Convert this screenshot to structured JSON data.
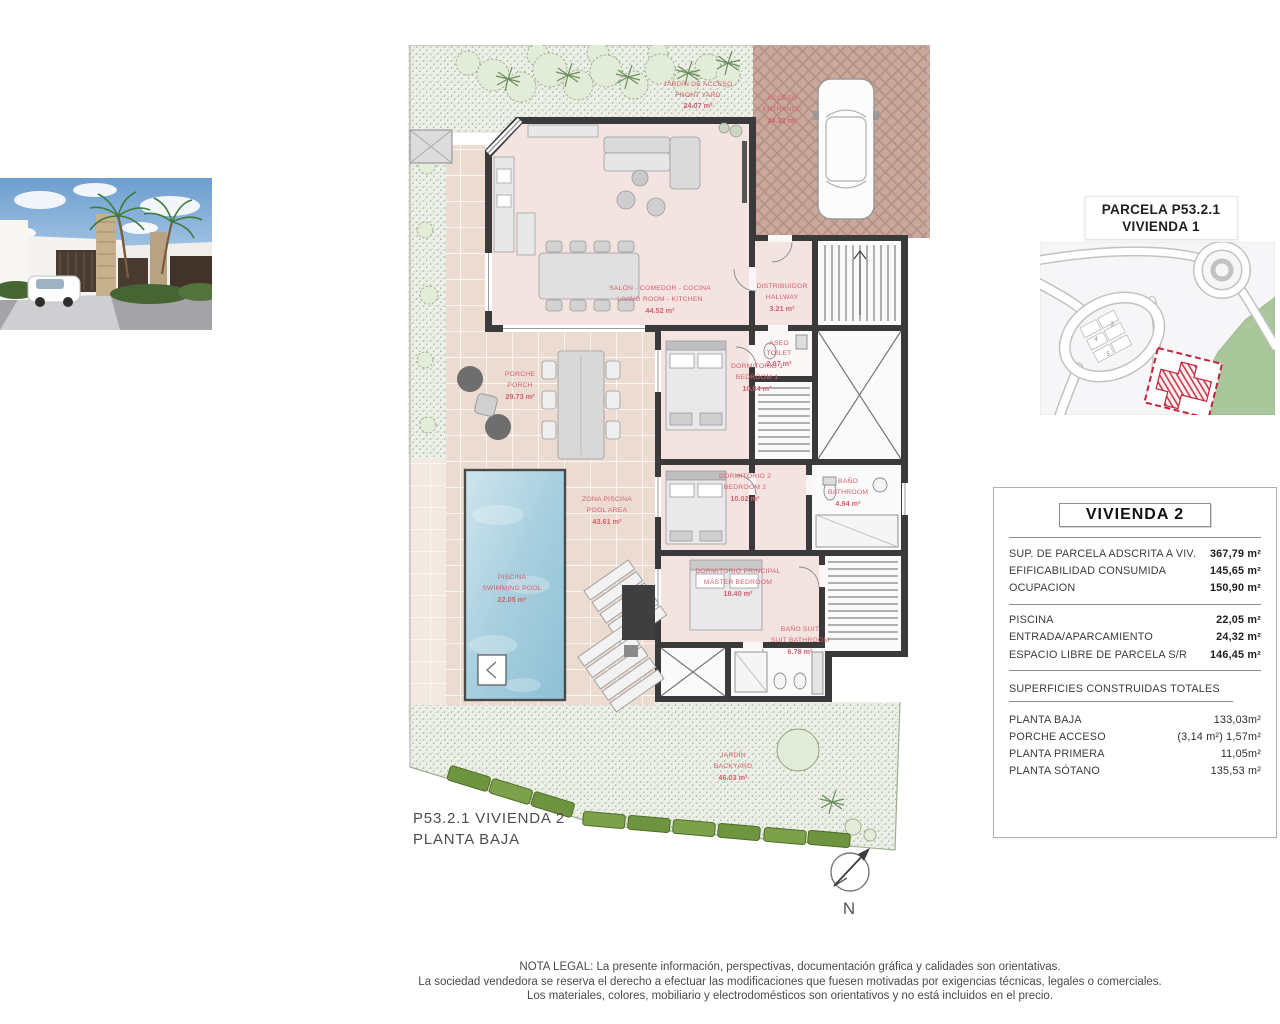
{
  "colors": {
    "label_red": "#d5606e",
    "wall_dark": "#3a3a3a",
    "pool_blue": "#aed3e3",
    "garden_green": "#9fb792",
    "map_green": "#a9c79b",
    "parcel_red": "#c2243a"
  },
  "map": {
    "title_line1": "PARCELA P53.2.1",
    "title_line2": "VIVIENDA 1",
    "lot_numbers": [
      "3",
      "4",
      "5"
    ]
  },
  "plan": {
    "caption_line1": "P53.2.1 VIVIENDA 2",
    "caption_line2": "PLANTA BAJA",
    "north_label": "N",
    "labels": {
      "front_yard": {
        "es": "JARDÍN DE ACCESO",
        "en": "FRONT YARD",
        "area": "24.07 m²"
      },
      "entrance": {
        "es": "ACCESO",
        "en": "ENTRANCE",
        "area": "24.32 m²"
      },
      "living": {
        "es": "SALÓN - COMEDOR - COCINA",
        "en": "LIVING ROOM - KITCHEN",
        "area": "44.52 m²"
      },
      "hallway": {
        "es": "DISTRIBUIDOR",
        "en": "HALLWAY",
        "area": "3.21 m²"
      },
      "toilet": {
        "es": "ASEO",
        "en": "TOILET",
        "area": "2.07 m²"
      },
      "bedroom1": {
        "es": "DORMITORIO 1",
        "en": "BEDROOM 1",
        "area": "10.84 m²"
      },
      "bedroom2": {
        "es": "DORMITORIO 2",
        "en": "BEDROOM 2",
        "area": "10.02 m²"
      },
      "bathroom": {
        "es": "BAÑO",
        "en": "BATHROOM",
        "area": "4.94 m²"
      },
      "master_bedroom": {
        "es": "DORMITORIO PRINCIPAL",
        "en": "MÁSTER BEDROOM",
        "area": "18.40 m²"
      },
      "suite_bathroom": {
        "es": "BAÑO SUIT",
        "en": "SUIT BATHROOM",
        "area": "6.78 m²"
      },
      "porch": {
        "es": "PORCHE",
        "en": "PORCH",
        "area": "29.73 m²"
      },
      "pool_area": {
        "es": "ZONA PISCINA",
        "en": "POOL AREA",
        "area": "43.61 m²"
      },
      "pool": {
        "es": "PISCINA",
        "en": "SWIMMING POOL",
        "area": "22.05 m²"
      },
      "backyard": {
        "es": "JARDÍN",
        "en": "BACKYARD",
        "area": "46.03 m²"
      }
    }
  },
  "panel": {
    "title": "VIVIENDA 2",
    "rows1": [
      {
        "label": "SUP. DE PARCELA ADSCRITA A VIV.",
        "value": "367,79 m²"
      },
      {
        "label": "EFIFICABILIDAD CONSUMIDA",
        "value": "145,65 m²"
      },
      {
        "label": "OCUPACION",
        "value": "150,90 m²"
      }
    ],
    "rows2": [
      {
        "label": "PISCINA",
        "value": "22,05 m²"
      },
      {
        "label": "ENTRADA/APARCAMIENTO",
        "value": "24,32 m²"
      },
      {
        "label": "ESPACIO LIBRE DE PARCELA S/R",
        "value": "146,45 m²"
      }
    ],
    "section_title": "SUPERFICIES CONSTRUIDAS TOTALES",
    "rows3": [
      {
        "label": "PLANTA BAJA",
        "value": "133,03m²"
      },
      {
        "label": "PORCHE ACCESO",
        "value": "(3,14 m²) 1,57m²"
      },
      {
        "label": "PLANTA PRIMERA",
        "value": "11,05m²"
      },
      {
        "label": "PLANTA SÓTANO",
        "value": "135,53 m²"
      }
    ]
  },
  "legal": {
    "line1": "NOTA LEGAL: La presente información, perspectivas, documentación gráfica y calidades son orientativas.",
    "line2": "La sociedad vendedora se reserva el derecho a efectuar las modificaciones que fuesen motivadas por exigencias técnicas, legales o comerciales.",
    "line3": "Los materiales, colores, mobiliario y electrodomésticos son orientativos y no está incluidos en el precio."
  }
}
